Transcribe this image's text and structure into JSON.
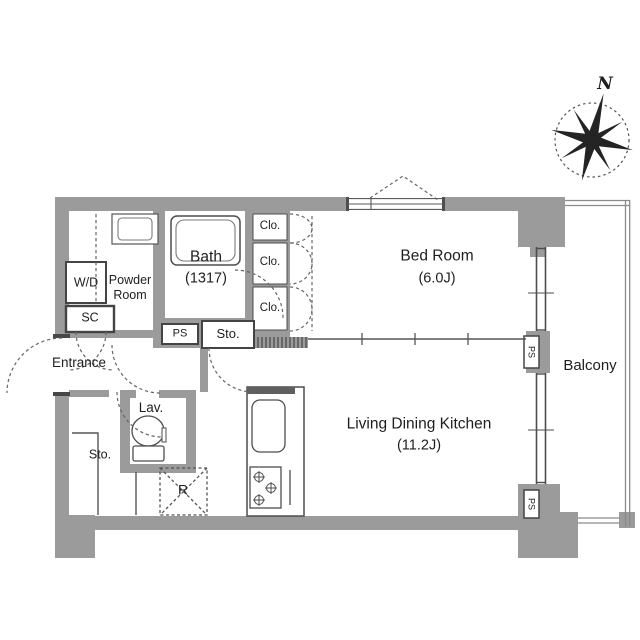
{
  "floorplan": {
    "compass": {
      "north_label": "N"
    },
    "labels": {
      "bedroom_name": "Bed Room",
      "bedroom_size": "(6.0J)",
      "ldk_name": "Living Dining Kitchen",
      "ldk_size": "(11.2J)",
      "bath_name": "Bath",
      "bath_size": "(1317)",
      "powder_room": "Powder Room",
      "washer_dryer": "W/D",
      "shoe_closet": "SC",
      "entrance": "Entrance",
      "hall_pipe_space": "PS",
      "hall_storage": "Sto.",
      "closet_top": "Clo.",
      "closet_middle": "Clo.",
      "closet_bottom": "Clo.",
      "lavatory": "Lav.",
      "lower_storage": "Sto.",
      "refrigerator_space": "R",
      "balcony_pipe_space_mid": "PS",
      "balcony_pipe_space_bottom": "PS",
      "balcony": "Balcony"
    },
    "colors": {
      "wall": "#9b9b9b",
      "line": "#4d4d4d",
      "floor": "#ffffff"
    }
  }
}
